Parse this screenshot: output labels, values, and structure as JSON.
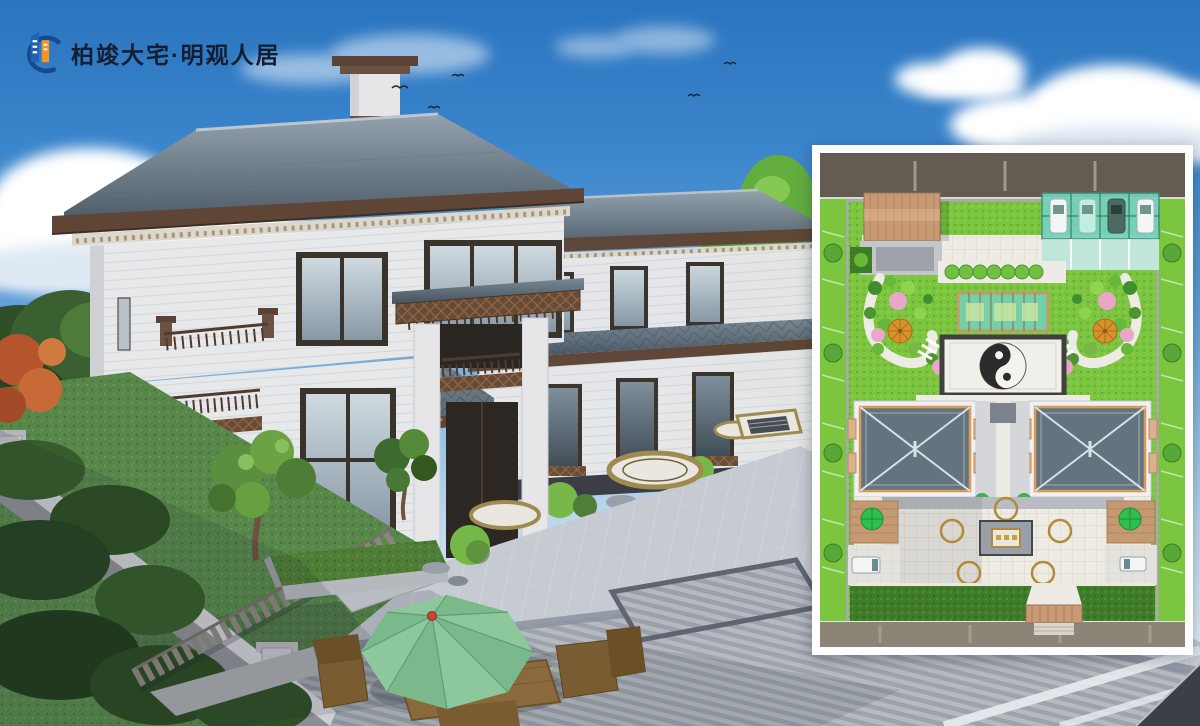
{
  "brand": {
    "logo_text": "柏竣大宅·明观人居",
    "logo_icon": "buildings-swoosh-icon"
  },
  "colors_scene": {
    "logo_text": "#141e33",
    "logo_blue": "#2063b5",
    "logo_blue_dark": "#17498f",
    "logo_orange": "#f6941e",
    "sky_top": "#2a74bf",
    "sky_horizon": "#e2eef8",
    "cloud": "#ffffff",
    "roof_slate_light": "#94a2ae",
    "roof_slate_dark": "#4d5a67",
    "roof_fascia_brown": "#5f4536",
    "cornice_cream": "#ddd8cb",
    "wall_white": "#e7e8ea",
    "window_frame": "#3a332b",
    "glass_blue": "#aebec9",
    "plaza_light": "#c6cad1",
    "plaza_band_dark": "#8b93a0",
    "ring_gold": "#9f8a50",
    "lawn_green": "#58874a",
    "tree_green_dark": "#35572c",
    "tree_green_bright": "#76b847",
    "autumn_red": "#b4552e",
    "umbrella_green": "#8cc89b",
    "umbrella_finial_red": "#cc4434",
    "wood_brown": "#8a6a3c"
  },
  "colors_plan": {
    "lawn": "#7cc63f",
    "hedge": "#3e7c27",
    "road_top": "#645c52",
    "road_bottom": "#8d8478",
    "boundary": "#b79fd6",
    "paving": "#edebe4",
    "canopy_tan": "#c89a74",
    "parking_glass": "#74d2bc",
    "umbrella_orange": "#d8922c",
    "umbrella_green": "#2fbf4f",
    "blossom_pink": "#e8a7c8",
    "roof": "#64747f",
    "roof_ridge": "#d7e1e8",
    "eave_trim": "#d99a56",
    "yin_dark": "#2b2b2b",
    "yin_light": "#f4f3ee",
    "car_white": "#f4f6f6"
  },
  "scene_elements": [
    "sky",
    "cumulus-clouds",
    "birds",
    "twin-chinese-villas",
    "hip-tile-roofs",
    "stone-plaza",
    "ring-paving-motifs",
    "garden-wall",
    "wood-fence",
    "pine-trees",
    "hedge-planter",
    "green-patio-umbrella",
    "outdoor-dining-set",
    "site-plan-inset"
  ],
  "site_plan_features": [
    "perimeter-road",
    "street-trees",
    "entry-canopy",
    "glass-parking-canopy",
    "parked-cars",
    "garden-paths",
    "flowering-trees",
    "orange-patio-umbrellas",
    "glass-pavilion",
    "yinyang-plaza",
    "twin-villa-roofs",
    "courtyard-ring-paving",
    "side-decks",
    "service-vehicles",
    "rear-hedge",
    "rear-entrance-canopy"
  ]
}
